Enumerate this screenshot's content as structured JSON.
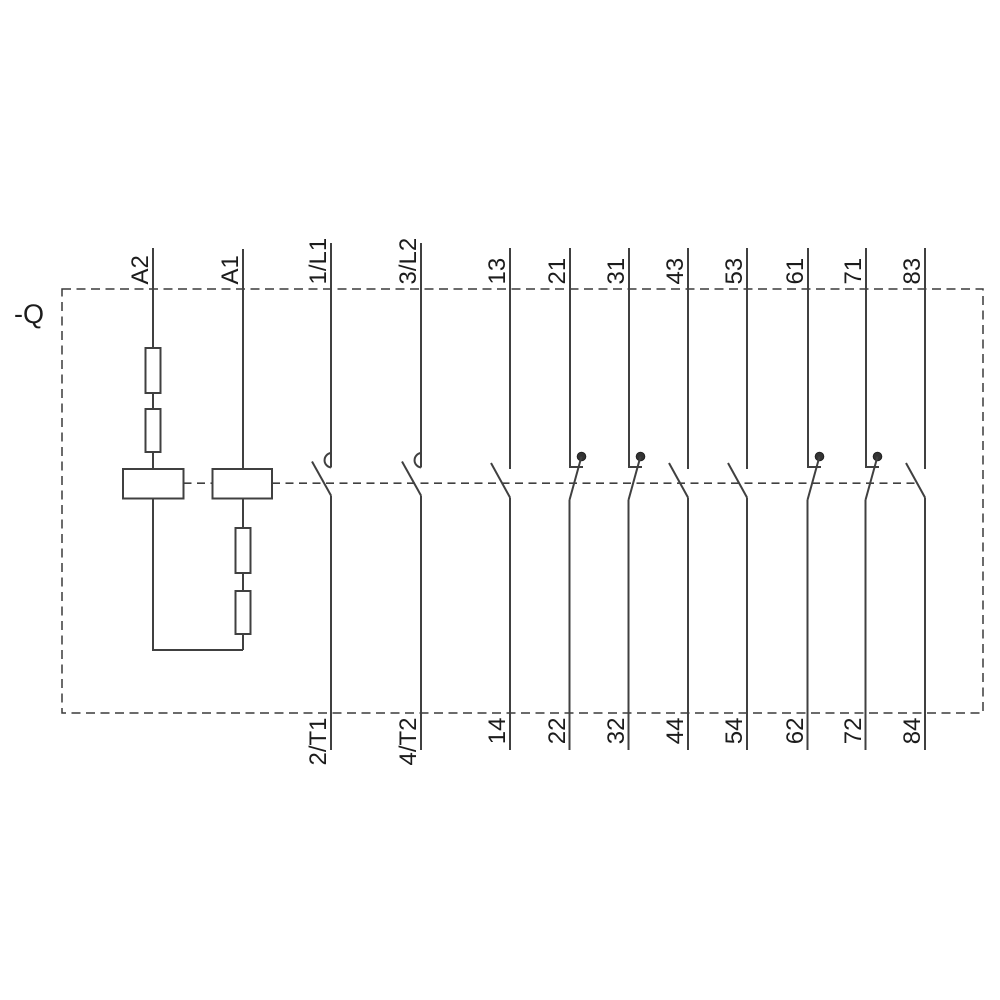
{
  "schematic": {
    "designation": "-Q",
    "coil": {
      "terminals": [
        "A2",
        "A1"
      ]
    },
    "poles": [
      {
        "top": "1/L1",
        "bottom": "2/T1",
        "kind": "main-no-contact"
      },
      {
        "top": "3/L2",
        "bottom": "4/T2",
        "kind": "main-no-contact"
      },
      {
        "top": "13",
        "bottom": "14",
        "kind": "no-contact"
      },
      {
        "top": "21",
        "bottom": "22",
        "kind": "nc-contact"
      },
      {
        "top": "31",
        "bottom": "32",
        "kind": "nc-contact"
      },
      {
        "top": "43",
        "bottom": "44",
        "kind": "no-contact"
      },
      {
        "top": "53",
        "bottom": "54",
        "kind": "no-contact"
      },
      {
        "top": "61",
        "bottom": "62",
        "kind": "nc-contact"
      },
      {
        "top": "71",
        "bottom": "72",
        "kind": "nc-contact"
      },
      {
        "top": "83",
        "bottom": "84",
        "kind": "no-contact"
      }
    ],
    "colors": {
      "line": "#404040",
      "text": "#1c1c1c",
      "background": "#ffffff"
    }
  }
}
